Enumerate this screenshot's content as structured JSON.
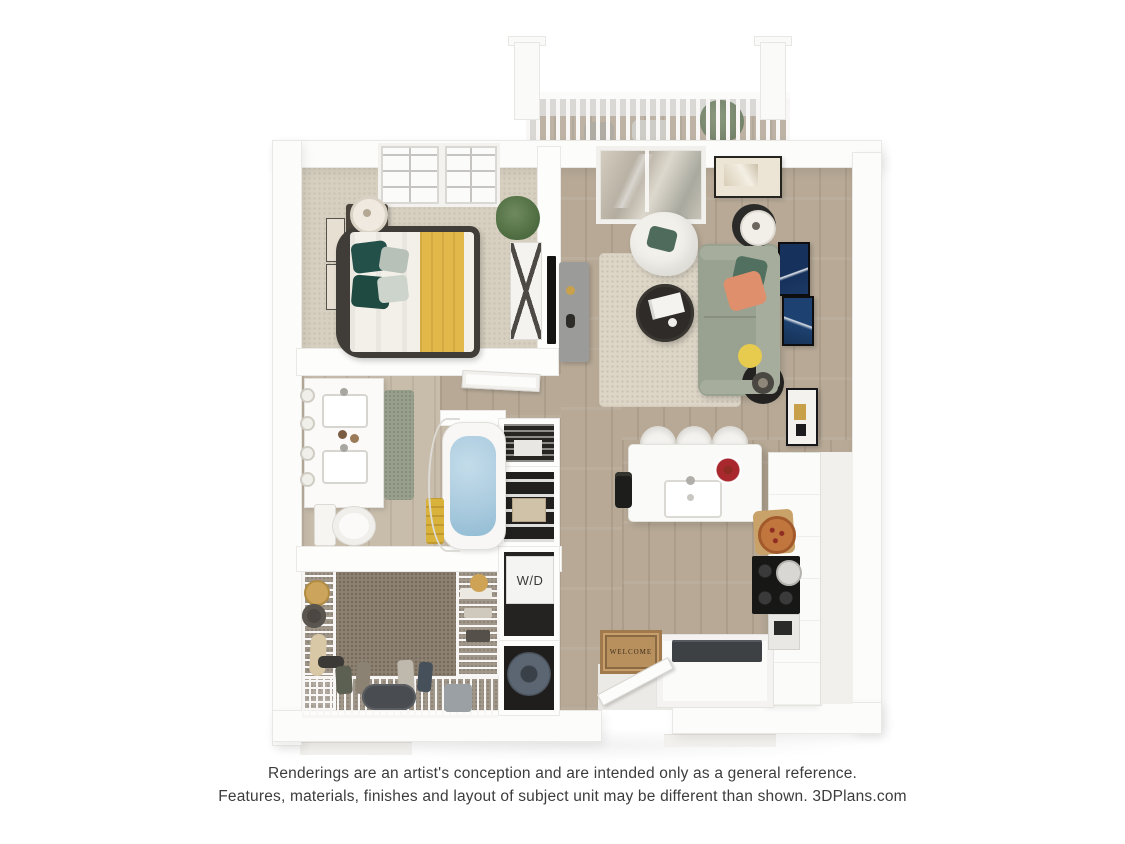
{
  "scene": {
    "background_color": "#ffffff",
    "type": "3d-floor-plan-rendering"
  },
  "labels": {
    "washer_dryer": "W/D",
    "welcome_mat": "WELCOME"
  },
  "rooms": [
    "balcony",
    "living-room",
    "bedroom",
    "bathroom",
    "walk-in-closet",
    "laundry-closet",
    "utility-closet",
    "kitchen",
    "entry",
    "hallway"
  ],
  "disclaimer": {
    "line1": "Renderings are an artist's conception and are intended only as a general reference.",
    "line2": "Features, materials, finishes and layout of subject unit may be different than shown. 3DPlans.com"
  },
  "colors": {
    "wall": "#ffffff",
    "wood_floor": "#b7a996",
    "bathroom_floor": "#c8bcab",
    "bedroom_carpet": "#d7d0c1",
    "closet_carpet": "#8d8172",
    "area_rug": "#ddd6c7",
    "sofa": "#99a191",
    "bed_blanket_yellow": "#e2b84a",
    "pillow_green": "#24504a",
    "pillow_coral": "#df8f6c",
    "tub_water": "#a9cade",
    "doormat": "#b8905e",
    "disclaimer_text": "#3c3c3c"
  }
}
